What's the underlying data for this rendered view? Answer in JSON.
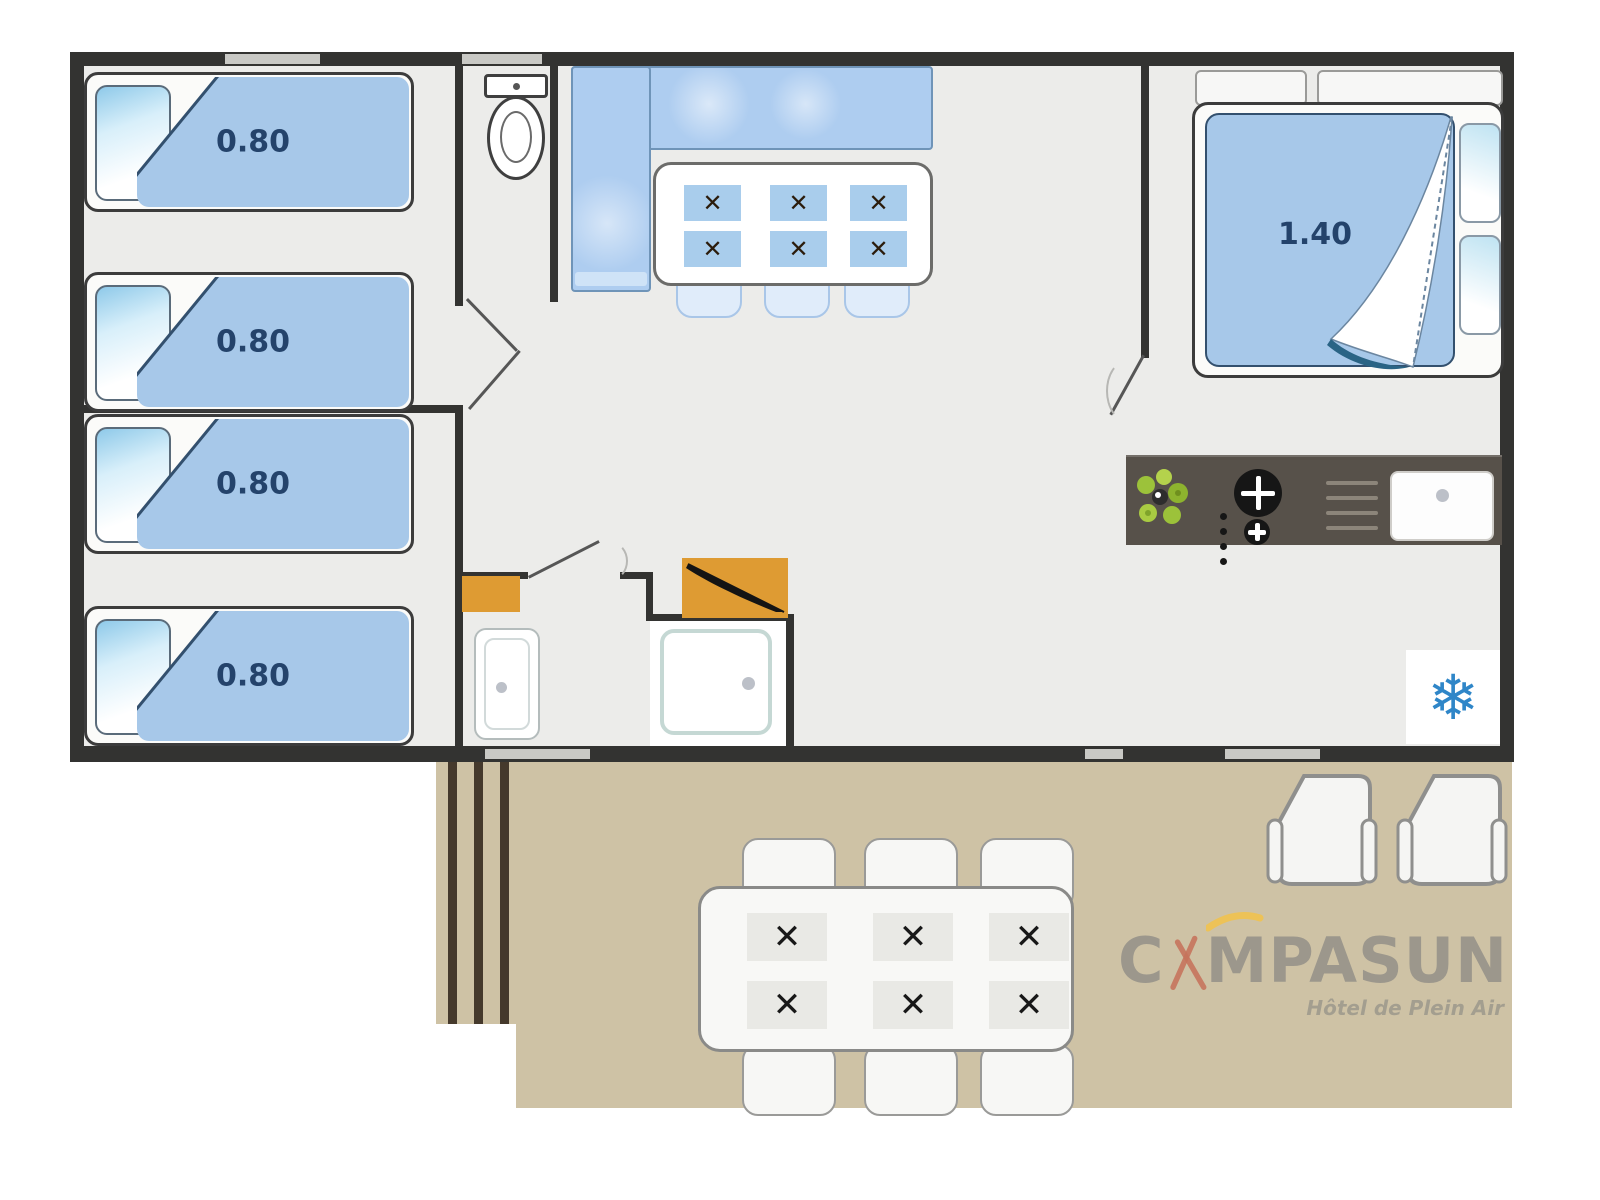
{
  "title": "Campasun mobile home floor plan",
  "floorplan": {
    "kids_beds": [
      {
        "label": "0.80"
      },
      {
        "label": "0.80"
      },
      {
        "label": "0.80"
      },
      {
        "label": "0.80"
      }
    ],
    "master_bed": {
      "label": "1.40"
    },
    "seat_marker": "✕",
    "ac_symbol": "❄"
  },
  "logo": {
    "prefix": "C",
    "suffix": "MPASUN",
    "tagline": "Hôtel de Plein Air"
  },
  "colors": {
    "bed_blue": "#a7c8e9",
    "bench_blue": "#aecdf0",
    "terrace_tan": "#cec2a5",
    "counter_dark": "#57514a",
    "cabinet_orange": "#de9b33",
    "snowflake_blue": "#2f86c8",
    "logo_gray": "#908d86",
    "logo_tent_red": "#c4604a",
    "logo_sun_yellow": "#f2c249",
    "wall_dark": "#333331",
    "floor_gray": "#ececea"
  }
}
